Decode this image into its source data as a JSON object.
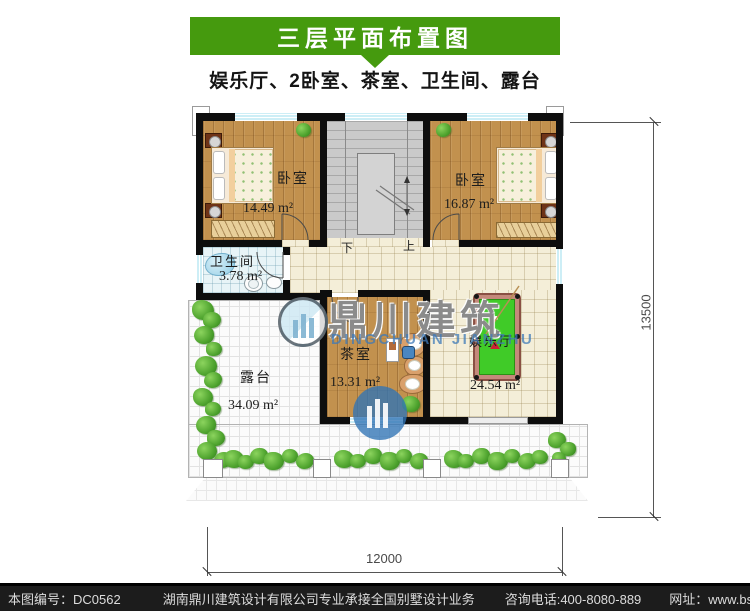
{
  "header": {
    "title": "三层平面布置图",
    "subtitle": "娱乐厅、2卧室、茶室、卫生间、露台"
  },
  "plan": {
    "rooms": [
      {
        "id": "bedroom-left",
        "name": "卧室",
        "area": "14.49 m²"
      },
      {
        "id": "bedroom-right",
        "name": "卧室",
        "area": "16.87 m²"
      },
      {
        "id": "bathroom",
        "name": "卫生间",
        "area": "3.78 m²"
      },
      {
        "id": "tea-room",
        "name": "茶室",
        "area": "13.31 m²"
      },
      {
        "id": "entertainment",
        "name": "娱乐厅",
        "area": "24.54 m²"
      },
      {
        "id": "terrace",
        "name": "露台",
        "area": "34.09 m²"
      }
    ],
    "stairs": {
      "down": "下",
      "up": "上"
    },
    "dimensions": {
      "width": "12000",
      "height": "13500"
    }
  },
  "watermark": {
    "cn": "鼎川建筑",
    "en": "DINGCHUAN JIANZHU"
  },
  "footer": {
    "code": "本图编号：DC0562",
    "company": "湖南鼎川建筑设计有限公司专业承接全国别墅设计业务",
    "phone": "咨询电话:400-8080-889",
    "site": "网址：www.bstzcs.com"
  },
  "colors": {
    "accent_green": "#459a0e",
    "wall": "#0e0e0e",
    "pool_table": "#40cb28",
    "window": "#cdeef6"
  }
}
